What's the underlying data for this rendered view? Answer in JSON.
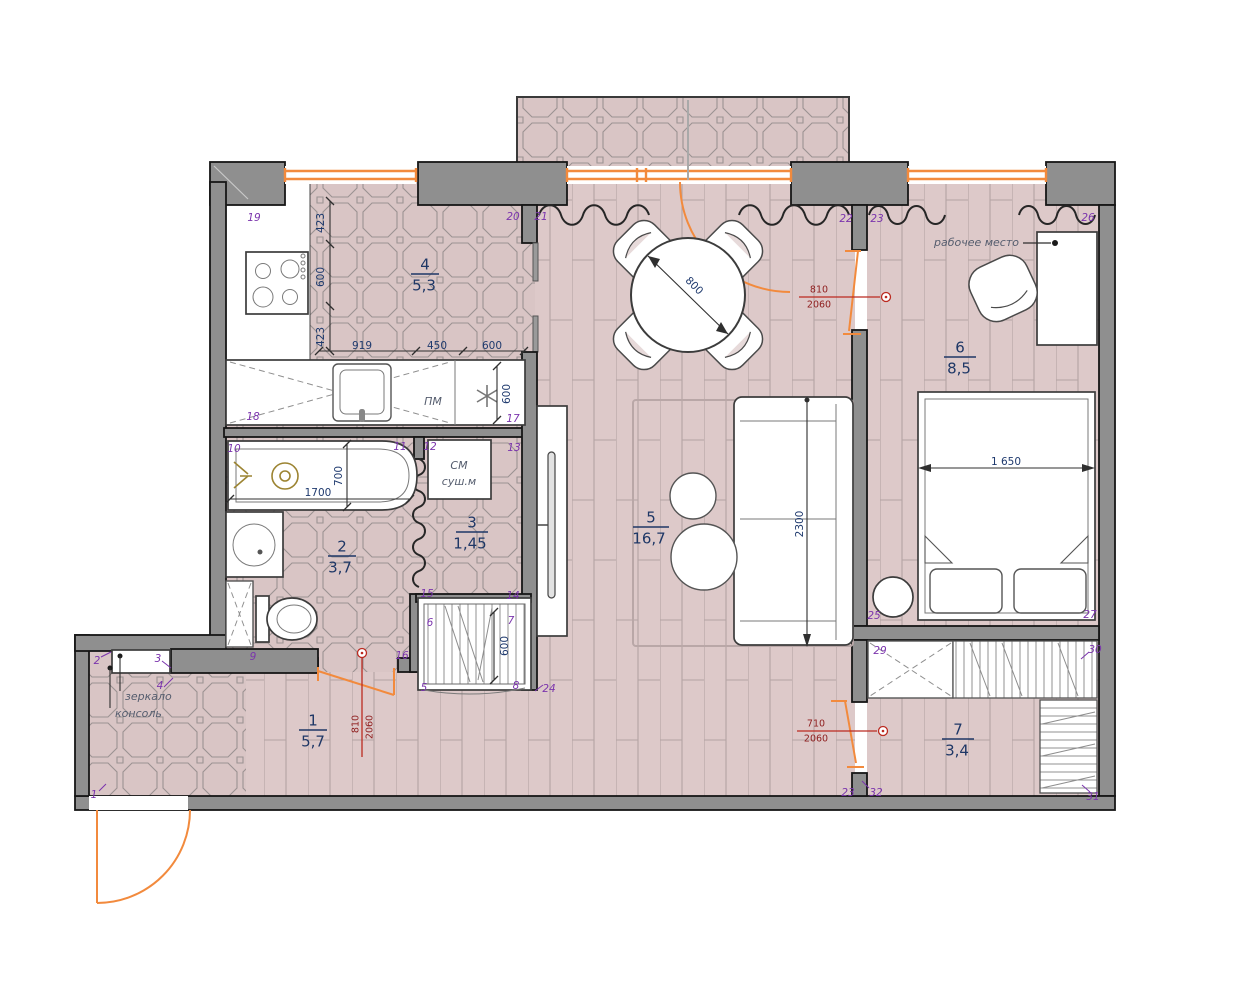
{
  "plan": {
    "rooms": [
      {
        "num": "1",
        "area": "5,7"
      },
      {
        "num": "2",
        "area": "3,7"
      },
      {
        "num": "3",
        "area": "1,45"
      },
      {
        "num": "4",
        "area": "5,3"
      },
      {
        "num": "5",
        "area": "16,7"
      },
      {
        "num": "6",
        "area": "8,5"
      },
      {
        "num": "7",
        "area": "3,4"
      }
    ],
    "dims": {
      "kitchen_left_top": "423",
      "kitchen_left_mid": "600",
      "kitchen_left_bot": "423",
      "kitchen_counter_1": "919",
      "kitchen_counter_2": "450",
      "kitchen_counter_3": "600",
      "fridge_depth": "600",
      "bath_length": "1700",
      "bath_width": "700",
      "table_diameter": "800",
      "sofa_length": "2300",
      "bed_width": "1 650",
      "wardrobe_depth": "600"
    },
    "door_dims": [
      {
        "w": "810",
        "h": "2060"
      },
      {
        "w": "810",
        "h": "2060"
      },
      {
        "w": "710",
        "h": "2060"
      }
    ],
    "labels": {
      "workplace": "рабочее место",
      "washer": "СМ",
      "dryer": "суш.м",
      "dishwasher": "ПМ",
      "mirror": "зеркало",
      "console": "консоль"
    },
    "markers": [
      "1",
      "2",
      "3",
      "4",
      "5",
      "6",
      "7",
      "8",
      "9",
      "10",
      "11",
      "12",
      "13",
      "14",
      "15",
      "16",
      "17",
      "18",
      "19",
      "20",
      "21",
      "22",
      "23",
      "24",
      "25",
      "26",
      "27",
      "29",
      "30",
      "31",
      "32",
      "23"
    ],
    "colors": {
      "wall": "#8f8f8f",
      "floor_tile": "#d9c5c5",
      "floor_plank": "#ddc9c9",
      "window": "#f28a3d",
      "door": "#f28a3d",
      "dim_text": "#1f3a6e",
      "marker": "#7b35ad",
      "door_dim": "#bb2a20"
    }
  }
}
